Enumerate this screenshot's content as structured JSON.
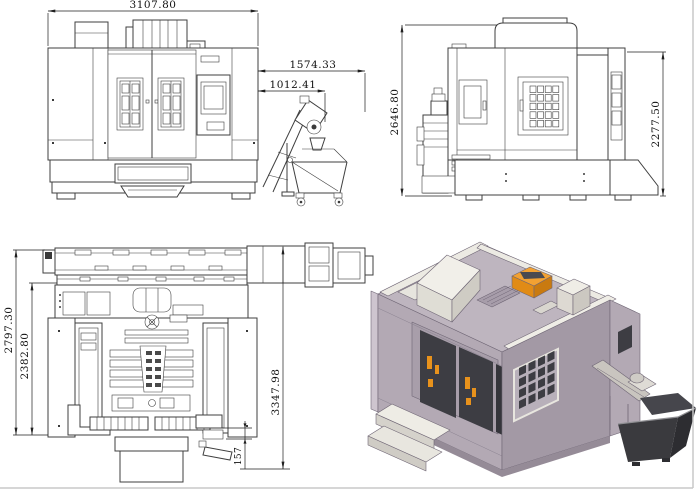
{
  "drawing": {
    "dimensions": {
      "front": {
        "overall_width": "3107.80",
        "conveyor_overall": "1574.33",
        "conveyor_first": "1012.41"
      },
      "side": {
        "overall_height": "2646.80",
        "rear_column_height": "2277.50"
      },
      "top": {
        "overall_depth": "2797.30",
        "body_depth": "2382.80",
        "total_length_with_conveyor": "3347.98",
        "rear_offset": "157"
      }
    },
    "colors": {
      "background": "#ffffff",
      "drawing_line": "#3f3f3f",
      "dimension_line": "#1f1f1f",
      "page_border": "#c8c8c8",
      "iso_body": "#b3a9b4",
      "iso_body_shade": "#a399a5",
      "iso_panel_light": "#efede6",
      "iso_window_dark": "#3d3d43",
      "iso_accent_orange": "#e8921c",
      "iso_cart_dark": "#3a3a3e"
    }
  }
}
